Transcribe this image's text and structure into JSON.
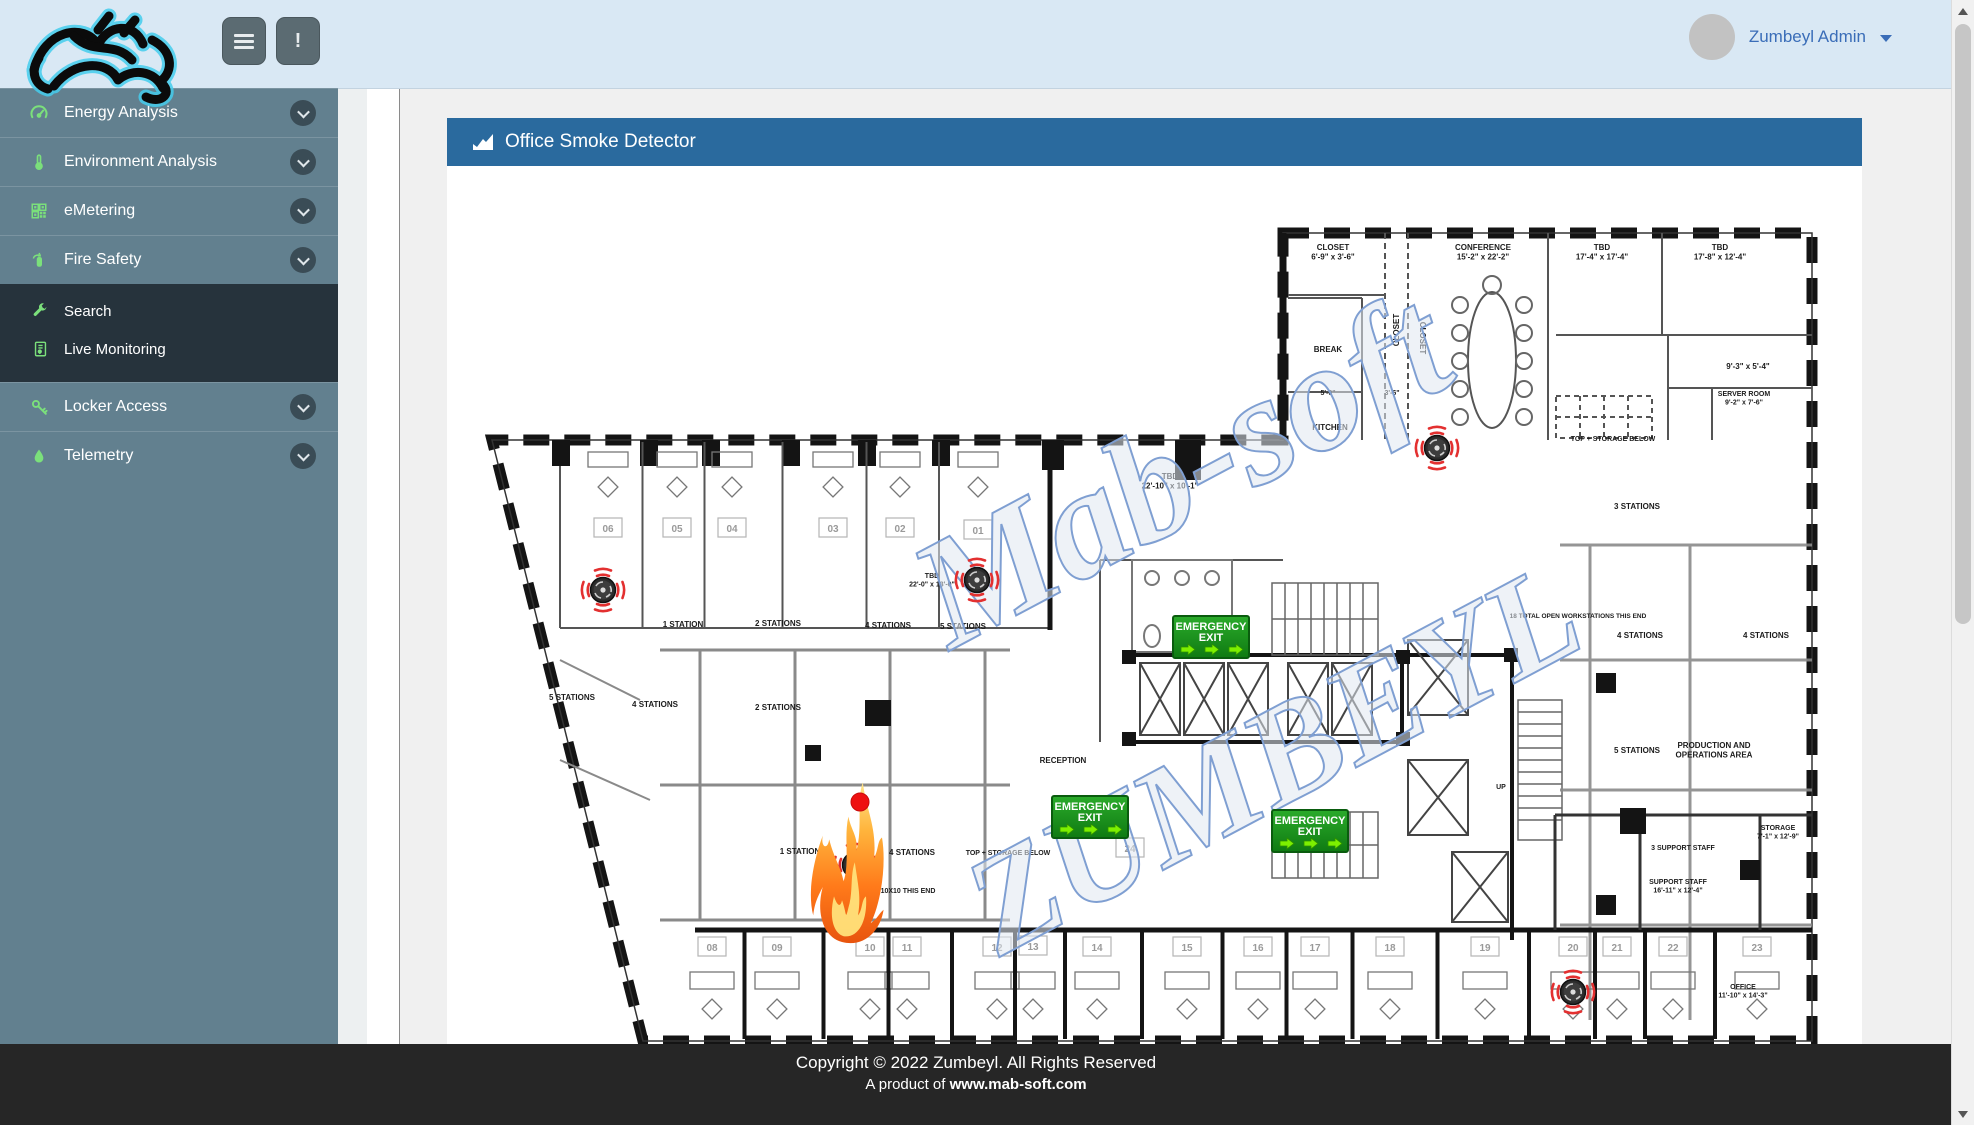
{
  "navbar": {
    "user_menu_label": "Zumbeyl Admin",
    "alert_glyph": "!"
  },
  "sidebar": {
    "sections": [
      {
        "type": "item",
        "id": "energy-analysis",
        "label": "Energy Analysis",
        "icon": "gauge-icon",
        "expandable": true,
        "active": false
      },
      {
        "type": "item",
        "id": "environment-analysis",
        "label": "Environment Analysis",
        "icon": "thermometer-icon",
        "expandable": true,
        "active": false
      },
      {
        "type": "item",
        "id": "emetering",
        "label": "eMetering",
        "icon": "meter-icon",
        "expandable": true,
        "active": false
      },
      {
        "type": "item",
        "id": "fire-safety",
        "label": "Fire Safety",
        "icon": "fire-extinguisher-icon",
        "expandable": true,
        "active": true
      },
      {
        "type": "submenu",
        "items": [
          {
            "id": "search",
            "label": "Search",
            "icon": "wrench-icon"
          },
          {
            "id": "live-monitoring",
            "label": "Live Monitoring",
            "icon": "report-icon"
          }
        ]
      },
      {
        "type": "item",
        "id": "locker-access",
        "label": "Locker Access",
        "icon": "key-icon",
        "expandable": true,
        "active": false
      },
      {
        "type": "item",
        "id": "telemetry",
        "label": "Telemetry",
        "icon": "drop-icon",
        "expandable": true,
        "active": false
      }
    ]
  },
  "panel": {
    "title": "Office Smoke Detector"
  },
  "footer": {
    "line1": "Copyright © 2022 Zumbeyl. All Rights Reserved",
    "line2_prefix": "A product of ",
    "line2_link": "www.mab-soft.com"
  },
  "floorplan": {
    "exit_label_line1": "EMERGENCY",
    "exit_label_line2": "EXIT",
    "colors": {
      "exit_green": "#1d9a1f",
      "exit_arrow": "#7df000",
      "alarm_red": "#ee1111",
      "detector_red": "#e33030",
      "watermark_blue": "#7f9fd2",
      "header_blue": "#2a6a9e"
    },
    "watermarks": [
      {
        "text": "Mab-soft",
        "x": 1205,
        "y": 515,
        "size": 155,
        "rotate": -28
      },
      {
        "text": "ZUMBEYL",
        "x": 1295,
        "y": 800,
        "size": 140,
        "rotate": -28
      }
    ],
    "labels": [
      {
        "t": "CLOSET\n6'-9\" x 3'-6\"",
        "x": 1333,
        "y": 250
      },
      {
        "t": "CONFERENCE\n15'-2\" x 22'-2\"",
        "x": 1483,
        "y": 250
      },
      {
        "t": "TBD\n17'-4\" x 17'-4\"",
        "x": 1602,
        "y": 250
      },
      {
        "t": "TBD\n17'-8\" x 12'-4\"",
        "x": 1720,
        "y": 250
      },
      {
        "t": "BREAK",
        "x": 1328,
        "y": 352
      },
      {
        "t": "KITCHEN",
        "x": 1330,
        "y": 430
      },
      {
        "t": "CLOSET",
        "x": 1399,
        "y": 330,
        "r": -90
      },
      {
        "t": "CLOSET",
        "x": 1420,
        "y": 338,
        "r": 90
      },
      {
        "t": "5'-0\"",
        "x": 1328,
        "y": 395,
        "s": 7
      },
      {
        "t": "3'-6\"",
        "x": 1392,
        "y": 395,
        "s": 7
      },
      {
        "t": "9'-3\" x 5'-4\"",
        "x": 1748,
        "y": 369
      },
      {
        "t": "SERVER ROOM\n9'-2\" x 7'-6\"",
        "x": 1744,
        "y": 396,
        "s": 7
      },
      {
        "t": "TOP + STORAGE BELOW",
        "x": 1613,
        "y": 441,
        "s": 7
      },
      {
        "t": "3 STATIONS",
        "x": 1637,
        "y": 509
      },
      {
        "t": "TBD\n22'-10\" x 10'-1\"",
        "x": 1170,
        "y": 479
      },
      {
        "t": "TBD\n22'-0\" x 13'-0\"",
        "x": 932,
        "y": 578,
        "s": 7
      },
      {
        "t": "1 STATION",
        "x": 683,
        "y": 627
      },
      {
        "t": "2 STATIONS",
        "x": 778,
        "y": 626
      },
      {
        "t": "4 STATIONS",
        "x": 888,
        "y": 628
      },
      {
        "t": "5 STATIONS",
        "x": 963,
        "y": 629
      },
      {
        "t": "5 STATIONS",
        "x": 572,
        "y": 700
      },
      {
        "t": "4 STATIONS",
        "x": 655,
        "y": 707
      },
      {
        "t": "2 STATIONS",
        "x": 778,
        "y": 710
      },
      {
        "t": "1 STATION",
        "x": 800,
        "y": 854
      },
      {
        "t": "4 STATIONS",
        "x": 912,
        "y": 855
      },
      {
        "t": "10X10 THIS END",
        "x": 908,
        "y": 893,
        "s": 7
      },
      {
        "t": "TOP + STORAGE BELOW",
        "x": 1008,
        "y": 855,
        "s": 7
      },
      {
        "t": "RECEPTION",
        "x": 1063,
        "y": 763
      },
      {
        "t": "18 TOTAL OPEN WORKSTATIONS THIS END",
        "x": 1578,
        "y": 618,
        "s": 6.5
      },
      {
        "t": "4 STATIONS",
        "x": 1640,
        "y": 638
      },
      {
        "t": "4 STATIONS",
        "x": 1766,
        "y": 638
      },
      {
        "t": "5 STATIONS",
        "x": 1637,
        "y": 753
      },
      {
        "t": "PRODUCTION AND\nOPERATIONS AREA",
        "x": 1714,
        "y": 748
      },
      {
        "t": "UP",
        "x": 1501,
        "y": 789,
        "s": 7
      },
      {
        "t": "3 SUPPORT STAFF",
        "x": 1683,
        "y": 850,
        "s": 7
      },
      {
        "t": "SUPPORT STAFF\n16'-11\" x 12'-4\"",
        "x": 1678,
        "y": 884,
        "s": 7
      },
      {
        "t": "STORAGE\n7'-1\" x 12'-9\"",
        "x": 1778,
        "y": 830,
        "s": 7
      },
      {
        "t": "OFFICE\n11'-10\" x 14'-3\"",
        "x": 1743,
        "y": 989,
        "s": 7
      }
    ],
    "office_numbers": [
      {
        "n": "06",
        "x": 608,
        "y": 528
      },
      {
        "n": "05",
        "x": 677,
        "y": 528
      },
      {
        "n": "04",
        "x": 732,
        "y": 528
      },
      {
        "n": "03",
        "x": 833,
        "y": 528
      },
      {
        "n": "02",
        "x": 900,
        "y": 528
      },
      {
        "n": "01",
        "x": 978,
        "y": 530
      },
      {
        "n": "08",
        "x": 712,
        "y": 947
      },
      {
        "n": "09",
        "x": 777,
        "y": 947
      },
      {
        "n": "10",
        "x": 870,
        "y": 947
      },
      {
        "n": "11",
        "x": 907,
        "y": 947
      },
      {
        "n": "12",
        "x": 997,
        "y": 947
      },
      {
        "n": "13",
        "x": 1033,
        "y": 946
      },
      {
        "n": "14",
        "x": 1097,
        "y": 947
      },
      {
        "n": "15",
        "x": 1187,
        "y": 947
      },
      {
        "n": "16",
        "x": 1258,
        "y": 947
      },
      {
        "n": "17",
        "x": 1315,
        "y": 947
      },
      {
        "n": "18",
        "x": 1390,
        "y": 947
      },
      {
        "n": "19",
        "x": 1485,
        "y": 947
      },
      {
        "n": "20",
        "x": 1573,
        "y": 947
      },
      {
        "n": "21",
        "x": 1617,
        "y": 947
      },
      {
        "n": "22",
        "x": 1673,
        "y": 947
      },
      {
        "n": "23",
        "x": 1757,
        "y": 947
      },
      {
        "n": "24",
        "x": 1130,
        "y": 848
      }
    ],
    "detectors": [
      {
        "x": 603,
        "y": 590
      },
      {
        "x": 977,
        "y": 580
      },
      {
        "x": 1437,
        "y": 448
      },
      {
        "x": 855,
        "y": 865
      },
      {
        "x": 1573,
        "y": 992
      }
    ],
    "exits": [
      {
        "x": 1211,
        "y": 637
      },
      {
        "x": 1090,
        "y": 817
      },
      {
        "x": 1310,
        "y": 831
      }
    ],
    "fire": {
      "x": 842,
      "y": 942
    },
    "alarm_dot": {
      "x": 860,
      "y": 802,
      "r": 9
    }
  }
}
